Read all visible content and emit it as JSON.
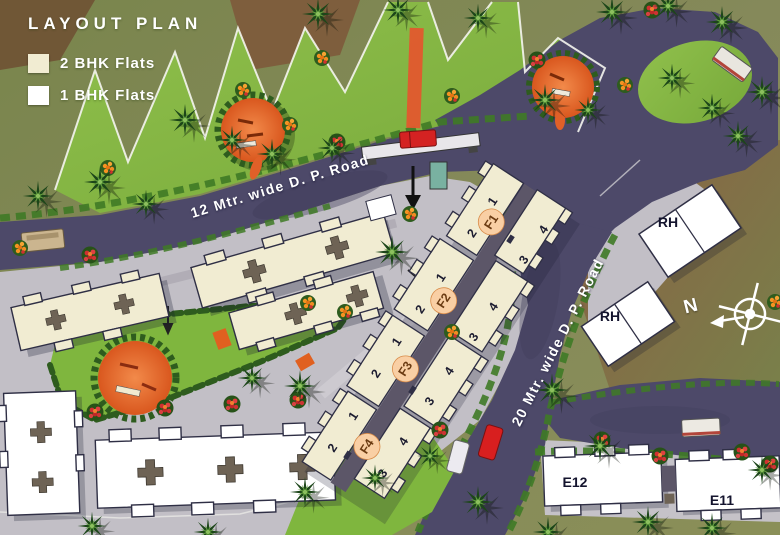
{
  "legend": {
    "title": "LAYOUT PLAN",
    "items": [
      {
        "label": "2 BHK Flats",
        "swatch": "#f1ecd2"
      },
      {
        "label": "1 BHK Flats",
        "swatch": "#ffffff"
      }
    ]
  },
  "roads": {
    "road_12m": {
      "label": "12 Mtr. wide D. P. Road"
    },
    "road_20m": {
      "label": "20 Mtr. wide D. P. Road"
    }
  },
  "buildings": {
    "f_blocks": [
      {
        "label": "F1",
        "units": [
          "1",
          "2",
          "3",
          "4"
        ]
      },
      {
        "label": "F2",
        "units": [
          "1",
          "2",
          "3",
          "4"
        ]
      },
      {
        "label": "F3",
        "units": [
          "1",
          "2",
          "3",
          "4"
        ]
      },
      {
        "label": "F4",
        "units": [
          "1",
          "2",
          "3",
          "4"
        ]
      }
    ],
    "e_blocks": [
      {
        "label": "E12"
      },
      {
        "label": "E11"
      }
    ],
    "rh_blocks": [
      {
        "label": "RH"
      },
      {
        "label": "RH"
      }
    ]
  },
  "compass": {
    "north_label": "N"
  },
  "colors": {
    "two_bhk_building": "#f1ecd2",
    "one_bhk_building": "#ffffff",
    "road": "#4d4969",
    "lawn": "#84b544",
    "playground": "#e8703a",
    "flat_label_circle": "#f9cfa4"
  }
}
